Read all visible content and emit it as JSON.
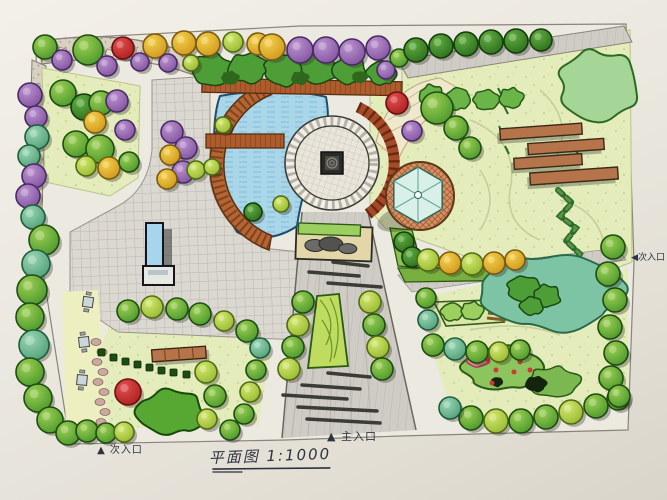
{
  "title": {
    "text": "平面图 1:1000"
  },
  "labels": {
    "main_entrance": "▲ 主入口",
    "side_entrance_bottom": "▲ 次入口",
    "side_entrance_right": "◀次入口"
  },
  "palette": {
    "paper": "#ece9e1",
    "path_gray": "#cfccc5",
    "plaza_gray": "#dbd8d1",
    "water": "#a9d6e8",
    "wood": "#ad5c2e",
    "lawn": "#e4ecbb",
    "tree_types": {
      "green": {
        "g1": "#9ccf52",
        "g2": "#4e9a2e",
        "s": "#1e4d12"
      },
      "dgreen": {
        "g1": "#5fae3f",
        "g2": "#2f7020",
        "s": "#143d0c"
      },
      "teal": {
        "g1": "#9ad6b4",
        "g2": "#54a27c",
        "s": "#1d5c3c"
      },
      "purple": {
        "g1": "#bb93cf",
        "g2": "#8456a2",
        "s": "#4a2a66"
      },
      "yellow": {
        "g1": "#f4d04a",
        "g2": "#d09a20",
        "s": "#7a5a10"
      },
      "red": {
        "g1": "#e05050",
        "g2": "#b02020",
        "s": "#6b0f0f"
      },
      "lime": {
        "g1": "#d2e86e",
        "g2": "#9aba34",
        "s": "#4f6b14"
      }
    }
  },
  "trees": [
    [
      45,
      47,
      12,
      "green"
    ],
    [
      62,
      60,
      10,
      "purple"
    ],
    [
      88,
      50,
      15,
      "green"
    ],
    [
      107,
      66,
      10,
      "purple"
    ],
    [
      123,
      48,
      11,
      "red"
    ],
    [
      140,
      62,
      9,
      "purple"
    ],
    [
      155,
      46,
      12,
      "yellow"
    ],
    [
      168,
      63,
      9,
      "purple"
    ],
    [
      184,
      43,
      12,
      "yellow"
    ],
    [
      191,
      63,
      8,
      "lime"
    ],
    [
      208,
      44,
      12,
      "yellow"
    ],
    [
      233,
      42,
      10,
      "lime"
    ],
    [
      258,
      44,
      11,
      "yellow"
    ],
    [
      272,
      47,
      13,
      "yellow"
    ],
    [
      300,
      50,
      13,
      "purple"
    ],
    [
      326,
      50,
      13,
      "purple"
    ],
    [
      352,
      52,
      13,
      "purple"
    ],
    [
      378,
      48,
      12,
      "purple"
    ],
    [
      386,
      70,
      9,
      "purple"
    ],
    [
      399,
      58,
      9,
      "green"
    ],
    [
      416,
      50,
      12,
      "dgreen"
    ],
    [
      441,
      46,
      12,
      "dgreen"
    ],
    [
      466,
      44,
      12,
      "dgreen"
    ],
    [
      491,
      42,
      12,
      "dgreen"
    ],
    [
      516,
      41,
      12,
      "dgreen"
    ],
    [
      541,
      40,
      11,
      "dgreen"
    ],
    [
      30,
      95,
      12,
      "purple"
    ],
    [
      36,
      117,
      11,
      "purple"
    ],
    [
      37,
      137,
      12,
      "teal"
    ],
    [
      29,
      156,
      11,
      "teal"
    ],
    [
      34,
      176,
      12,
      "purple"
    ],
    [
      28,
      196,
      12,
      "purple"
    ],
    [
      33,
      217,
      12,
      "teal"
    ],
    [
      44,
      240,
      15,
      "green"
    ],
    [
      36,
      264,
      14,
      "teal"
    ],
    [
      32,
      290,
      15,
      "green"
    ],
    [
      30,
      317,
      14,
      "green"
    ],
    [
      34,
      345,
      15,
      "teal"
    ],
    [
      30,
      372,
      14,
      "green"
    ],
    [
      38,
      398,
      14,
      "green"
    ],
    [
      50,
      420,
      13,
      "green"
    ],
    [
      68,
      433,
      12,
      "green"
    ],
    [
      87,
      431,
      11,
      "green"
    ],
    [
      106,
      433,
      10,
      "green"
    ],
    [
      124,
      432,
      10,
      "lime"
    ],
    [
      63,
      93,
      13,
      "green"
    ],
    [
      84,
      107,
      13,
      "dgreen"
    ],
    [
      101,
      103,
      12,
      "green"
    ],
    [
      117,
      101,
      11,
      "purple"
    ],
    [
      95,
      122,
      11,
      "yellow"
    ],
    [
      76,
      144,
      13,
      "green"
    ],
    [
      100,
      149,
      14,
      "green"
    ],
    [
      86,
      166,
      10,
      "lime"
    ],
    [
      109,
      168,
      11,
      "yellow"
    ],
    [
      129,
      162,
      10,
      "green"
    ],
    [
      125,
      130,
      10,
      "purple"
    ],
    [
      172,
      132,
      11,
      "purple"
    ],
    [
      186,
      148,
      11,
      "purple"
    ],
    [
      170,
      155,
      10,
      "yellow"
    ],
    [
      183,
      172,
      11,
      "purple"
    ],
    [
      167,
      179,
      10,
      "yellow"
    ],
    [
      196,
      170,
      9,
      "lime"
    ],
    [
      223,
      125,
      8,
      "lime"
    ],
    [
      212,
      167,
      8,
      "lime"
    ],
    [
      253,
      212,
      9,
      "dgreen"
    ],
    [
      281,
      204,
      8,
      "lime"
    ],
    [
      397,
      103,
      11,
      "red"
    ],
    [
      412,
      131,
      10,
      "purple"
    ],
    [
      437,
      108,
      16,
      "green"
    ],
    [
      456,
      128,
      12,
      "green"
    ],
    [
      470,
      148,
      11,
      "green"
    ],
    [
      404,
      242,
      10,
      "dgreen"
    ],
    [
      412,
      257,
      10,
      "dgreen"
    ],
    [
      428,
      260,
      11,
      "lime"
    ],
    [
      450,
      263,
      11,
      "yellow"
    ],
    [
      472,
      264,
      11,
      "lime"
    ],
    [
      494,
      263,
      11,
      "yellow"
    ],
    [
      515,
      260,
      10,
      "yellow"
    ],
    [
      613,
      247,
      12,
      "green"
    ],
    [
      608,
      274,
      12,
      "green"
    ],
    [
      615,
      300,
      12,
      "green"
    ],
    [
      610,
      327,
      12,
      "green"
    ],
    [
      616,
      353,
      12,
      "green"
    ],
    [
      611,
      378,
      12,
      "green"
    ],
    [
      618,
      399,
      11,
      "green"
    ],
    [
      471,
      418,
      12,
      "green"
    ],
    [
      496,
      421,
      12,
      "lime"
    ],
    [
      521,
      421,
      12,
      "green"
    ],
    [
      546,
      417,
      12,
      "green"
    ],
    [
      571,
      412,
      12,
      "lime"
    ],
    [
      596,
      406,
      12,
      "green"
    ],
    [
      619,
      396,
      11,
      "green"
    ],
    [
      450,
      408,
      11,
      "teal"
    ],
    [
      433,
      345,
      11,
      "green"
    ],
    [
      455,
      349,
      11,
      "teal"
    ],
    [
      477,
      352,
      11,
      "green"
    ],
    [
      499,
      352,
      10,
      "lime"
    ],
    [
      520,
      350,
      10,
      "green"
    ],
    [
      428,
      320,
      10,
      "teal"
    ],
    [
      426,
      298,
      10,
      "green"
    ],
    [
      128,
      311,
      11,
      "green"
    ],
    [
      152,
      307,
      11,
      "lime"
    ],
    [
      177,
      309,
      11,
      "green"
    ],
    [
      200,
      314,
      11,
      "green"
    ],
    [
      224,
      321,
      10,
      "lime"
    ],
    [
      247,
      331,
      11,
      "green"
    ],
    [
      260,
      348,
      10,
      "teal"
    ],
    [
      256,
      370,
      10,
      "green"
    ],
    [
      250,
      392,
      10,
      "lime"
    ],
    [
      244,
      414,
      10,
      "green"
    ],
    [
      230,
      430,
      10,
      "green"
    ],
    [
      206,
      372,
      11,
      "lime"
    ],
    [
      215,
      396,
      11,
      "green"
    ],
    [
      207,
      419,
      10,
      "lime"
    ],
    [
      128,
      392,
      13,
      "red"
    ],
    [
      303,
      302,
      11,
      "green"
    ],
    [
      298,
      325,
      11,
      "lime"
    ],
    [
      293,
      347,
      11,
      "green"
    ],
    [
      289,
      369,
      11,
      "lime"
    ],
    [
      370,
      302,
      11,
      "lime"
    ],
    [
      374,
      325,
      11,
      "green"
    ],
    [
      378,
      347,
      11,
      "lime"
    ],
    [
      382,
      369,
      11,
      "green"
    ]
  ],
  "blobs": [
    {
      "x": 212,
      "y": 70,
      "rx": 20,
      "ry": 16,
      "fill": "#4e9e38",
      "stroke": "#1b4710",
      "sw": 1.5,
      "seed": 1
    },
    {
      "x": 248,
      "y": 68,
      "rx": 20,
      "ry": 15,
      "fill": "#4e9e38",
      "stroke": "#1b4710",
      "sw": 1.5,
      "seed": 2
    },
    {
      "x": 284,
      "y": 70,
      "rx": 20,
      "ry": 16,
      "fill": "#4e9e38",
      "stroke": "#1b4710",
      "sw": 1.5,
      "seed": 3
    },
    {
      "x": 318,
      "y": 69,
      "rx": 19,
      "ry": 15,
      "fill": "#4e9e38",
      "stroke": "#1b4710",
      "sw": 1.5,
      "seed": 4
    },
    {
      "x": 350,
      "y": 70,
      "rx": 18,
      "ry": 14,
      "fill": "#4e9e38",
      "stroke": "#1b4710",
      "sw": 1.5,
      "seed": 5
    },
    {
      "x": 382,
      "y": 73,
      "rx": 15,
      "ry": 12,
      "fill": "#4e9e38",
      "stroke": "#1b4710",
      "sw": 1.5,
      "seed": 6
    },
    {
      "x": 230,
      "y": 78,
      "rx": 9,
      "ry": 7,
      "fill": "#2e681c",
      "stroke": "none",
      "sw": 0,
      "seed": 7
    },
    {
      "x": 300,
      "y": 78,
      "rx": 9,
      "ry": 7,
      "fill": "#2e681c",
      "stroke": "none",
      "sw": 0,
      "seed": 8
    },
    {
      "x": 360,
      "y": 77,
      "rx": 8,
      "ry": 6,
      "fill": "#2e681c",
      "stroke": "none",
      "sw": 0,
      "seed": 9
    },
    {
      "x": 598,
      "y": 86,
      "rx": 40,
      "ry": 36,
      "fill": "#a5d698",
      "stroke": "#2e6b22",
      "sw": 2,
      "seed": 10
    },
    {
      "x": 432,
      "y": 96,
      "rx": 13,
      "ry": 11,
      "fill": "#6ab448",
      "stroke": "#245a14",
      "sw": 1.5,
      "seed": 11
    },
    {
      "x": 458,
      "y": 99,
      "rx": 13,
      "ry": 11,
      "fill": "#6ab448",
      "stroke": "#245a14",
      "sw": 1.5,
      "seed": 12
    },
    {
      "x": 486,
      "y": 100,
      "rx": 13,
      "ry": 10,
      "fill": "#6ab448",
      "stroke": "#245a14",
      "sw": 1.5,
      "seed": 13
    },
    {
      "x": 511,
      "y": 98,
      "rx": 12,
      "ry": 10,
      "fill": "#6ab448",
      "stroke": "#245a14",
      "sw": 1.5,
      "seed": 14
    },
    {
      "x": 552,
      "y": 292,
      "rx": 72,
      "ry": 38,
      "fill": "#7cc4a4",
      "stroke": "#2a6a4a",
      "sw": 2,
      "seed": 15
    },
    {
      "x": 524,
      "y": 289,
      "rx": 17,
      "ry": 13,
      "fill": "#4e9e38",
      "stroke": "#1b4710",
      "sw": 1.5,
      "seed": 16
    },
    {
      "x": 547,
      "y": 296,
      "rx": 14,
      "ry": 11,
      "fill": "#4e9e38",
      "stroke": "#1b4710",
      "sw": 1.5,
      "seed": 17
    },
    {
      "x": 532,
      "y": 306,
      "rx": 12,
      "ry": 9,
      "fill": "#4e9e38",
      "stroke": "#1b4710",
      "sw": 1.5,
      "seed": 18
    },
    {
      "x": 502,
      "y": 368,
      "rx": 40,
      "ry": 22,
      "fill": "#8cc45e",
      "stroke": "#2a5a16",
      "sw": 2,
      "seed": 19
    },
    {
      "x": 553,
      "y": 382,
      "rx": 26,
      "ry": 15,
      "fill": "#7cb852",
      "stroke": "#2a5a16",
      "sw": 1.5,
      "seed": 20
    },
    {
      "x": 536,
      "y": 384,
      "rx": 11,
      "ry": 8,
      "fill": "#15240e",
      "stroke": "none",
      "sw": 0,
      "seed": 21
    },
    {
      "x": 497,
      "y": 382,
      "rx": 6,
      "ry": 5,
      "fill": "#15240e",
      "stroke": "none",
      "sw": 0,
      "seed": 22
    },
    {
      "x": 478,
      "y": 358,
      "rx": 12,
      "ry": 9,
      "fill": "#e88898",
      "stroke": "#a04050",
      "sw": 1.5,
      "seed": 23
    },
    {
      "x": 172,
      "y": 412,
      "rx": 36,
      "ry": 22,
      "fill": "#56a832",
      "stroke": "#184a0c",
      "sw": 2,
      "seed": 24
    },
    {
      "x": 452,
      "y": 312,
      "rx": 11,
      "ry": 9,
      "fill": "#9ccf60",
      "stroke": "#2a5a16",
      "sw": 1.5,
      "seed": 25
    },
    {
      "x": 472,
      "y": 311,
      "rx": 11,
      "ry": 9,
      "fill": "#9ccf60",
      "stroke": "#2a5a16",
      "sw": 1.5,
      "seed": 26
    }
  ],
  "red_dots": [
    [
      488,
      360
    ],
    [
      496,
      370
    ],
    [
      506,
      356
    ],
    [
      514,
      372
    ],
    [
      520,
      362
    ],
    [
      530,
      370
    ],
    [
      492,
      383
    ],
    [
      484,
      350
    ]
  ]
}
